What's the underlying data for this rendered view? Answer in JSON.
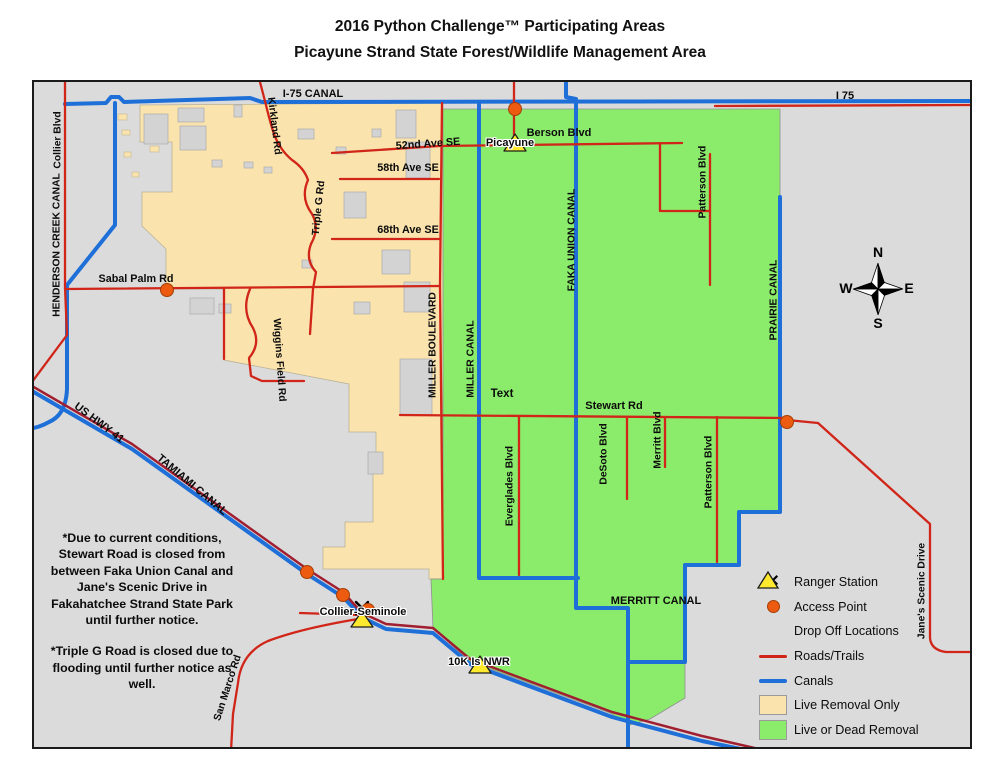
{
  "title": {
    "line1": "2016 Python Challenge™ Participating Areas",
    "line2": "Picayune Strand State Forest/Wildlife Management Area"
  },
  "notes": [
    "*Due to current conditions, Stewart Road is closed from between Faka Union Canal and Jane's Scenic Drive in Fakahatchee Strand State Park until further notice.",
    "*Triple G Road is closed due to flooding until further notice as well."
  ],
  "compass": {
    "n": "N",
    "s": "S",
    "e": "E",
    "w": "W"
  },
  "legend": {
    "items": [
      {
        "icon": "ranger-station",
        "label": "Ranger Station"
      },
      {
        "icon": "access-point",
        "label": "Access Point"
      },
      {
        "icon": "drop-off",
        "label": "Drop Off Locations"
      },
      {
        "icon": "roads-trails",
        "label": "Roads/Trails"
      },
      {
        "icon": "canals",
        "label": "Canals"
      },
      {
        "icon": "live-removal-only",
        "label": "Live Removal Only"
      },
      {
        "icon": "live-or-dead-removal",
        "label": "Live or Dead Removal"
      }
    ]
  },
  "map_labels": [
    {
      "text": "I-75 CANAL",
      "x": 311,
      "y": 92,
      "rot": 0,
      "size": 11
    },
    {
      "text": "I 75",
      "x": 843,
      "y": 94,
      "rot": 0,
      "size": 11
    },
    {
      "text": "Kirkland Rd",
      "x": 272,
      "y": 124,
      "rot": 83,
      "size": 10.3
    },
    {
      "text": "52nd Ave SE",
      "x": 426,
      "y": 142,
      "rot": -4,
      "size": 10.8
    },
    {
      "text": "58th Ave SE",
      "x": 406,
      "y": 166,
      "rot": 0,
      "size": 10.8
    },
    {
      "text": "68th Ave SE",
      "x": 406,
      "y": 228,
      "rot": 0,
      "size": 10.8
    },
    {
      "text": "Triple G Rd",
      "x": 317,
      "y": 206,
      "rot": -84,
      "size": 10.3
    },
    {
      "text": "Sabal Palm Rd",
      "x": 134,
      "y": 277,
      "rot": 0,
      "size": 10.8
    },
    {
      "text": "Wiggins Field Rd",
      "x": 277,
      "y": 358,
      "rot": 86,
      "size": 10.3
    },
    {
      "text": "MILLER BOULEVARD",
      "x": 431,
      "y": 343,
      "rot": -90,
      "size": 10.3
    },
    {
      "text": "MILLER CANAL",
      "x": 469,
      "y": 357,
      "rot": -90,
      "size": 10.3
    },
    {
      "text": "FAKA UNION CANAL",
      "x": 570,
      "y": 238,
      "rot": -90,
      "size": 10.3
    },
    {
      "text": "PRAIRIE CANAL",
      "x": 772,
      "y": 298,
      "rot": -90,
      "size": 10.3
    },
    {
      "text": "Picayune",
      "x": 508,
      "y": 141,
      "rot": 0,
      "size": 11,
      "halo": true
    },
    {
      "text": "Berson Blvd",
      "x": 557,
      "y": 131,
      "rot": 0,
      "size": 11
    },
    {
      "text": "Patterson Blvd",
      "x": 701,
      "y": 180,
      "rot": -90,
      "size": 10.3
    },
    {
      "text": "Stewart Rd",
      "x": 612,
      "y": 404,
      "rot": 0,
      "size": 11
    },
    {
      "text": "Text",
      "x": 500,
      "y": 392,
      "rot": 0,
      "size": 11.5
    },
    {
      "text": "Everglades Blvd",
      "x": 508,
      "y": 484,
      "rot": -90,
      "size": 10.3
    },
    {
      "text": "DeSoto Blvd",
      "x": 602,
      "y": 452,
      "rot": -90,
      "size": 10.3
    },
    {
      "text": "Merritt Blvd",
      "x": 656,
      "y": 438,
      "rot": -90,
      "size": 10.3
    },
    {
      "text": "Patterson Blvd",
      "x": 707,
      "y": 470,
      "rot": -90,
      "size": 10.3
    },
    {
      "text": "MERRITT CANAL",
      "x": 654,
      "y": 599,
      "rot": 0,
      "size": 11
    },
    {
      "text": "US HWY 41",
      "x": 97,
      "y": 421,
      "rot": 37,
      "size": 11
    },
    {
      "text": "TAMIAMI CANAL",
      "x": 190,
      "y": 483,
      "rot": 40,
      "size": 11
    },
    {
      "text": "Collier-Seminole",
      "x": 361,
      "y": 610,
      "rot": 0,
      "size": 11,
      "halo": true
    },
    {
      "text": "10K Is NWR",
      "x": 477,
      "y": 660,
      "rot": 0,
      "size": 11,
      "halo": true
    },
    {
      "text": "San Marco Rd",
      "x": 226,
      "y": 686,
      "rot": -72,
      "size": 10.3
    },
    {
      "text": "Jane's Scenic Drive",
      "x": 920,
      "y": 589,
      "rot": -90,
      "size": 10.3
    },
    {
      "text": "HENDERSON CREEK CANAL",
      "x": 55,
      "y": 243,
      "rot": -90,
      "size": 10.3
    },
    {
      "text": "Collier Blvd",
      "x": 56,
      "y": 138,
      "rot": -90,
      "size": 10.3
    }
  ],
  "colors": {
    "map_background": "#DBDBDB",
    "live_removal_only": "#FAE3AC",
    "live_or_dead_removal": "#8BEC6B",
    "roads_trails": "#D02518",
    "us_41_highway": "#A01E30",
    "canals": "#1F6FD8",
    "access_point": "#EC5B0F",
    "drop_off_location": "#FFE92F"
  }
}
